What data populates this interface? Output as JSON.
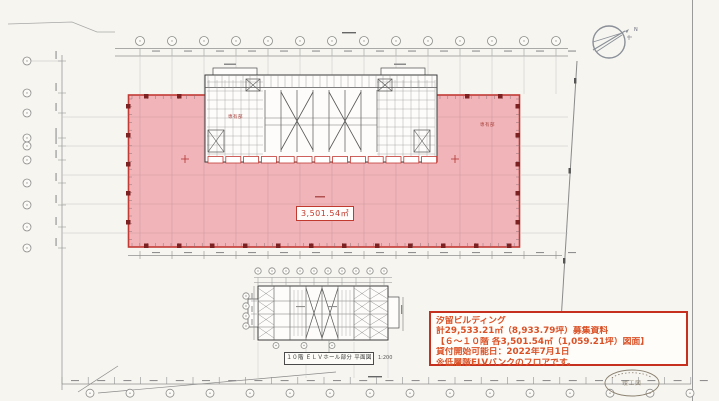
{
  "colors": {
    "paper": "#f6f5f0",
    "leasable_pink": "#f1b5b9",
    "boundary_red": "#c23a34",
    "annotation_border_red": "#c5301f",
    "annotation_text_red": "#da5126",
    "line_dark": "#3c3c3c",
    "line_light": "#9b9b9b"
  },
  "main_plan": {
    "area_label": "3,501.54㎡",
    "zone_label": "専有部"
  },
  "detail_plan": {
    "caption": "１０階 ＥＬＶホール部分 平面図",
    "scale": "1:200"
  },
  "annotation_box": {
    "lines": [
      "汐留ビルディング",
      "計29,533.21㎡（8,933.79坪）募集資料",
      "【６～１０階 各3,501.54㎡（1,059.21坪）図面】",
      "貸付開始可能日：2022年7月1日",
      "※低層階ELVバンクのフロアです。"
    ]
  },
  "stamp": {
    "label": "竣工図"
  },
  "compass": {
    "label": "N"
  }
}
